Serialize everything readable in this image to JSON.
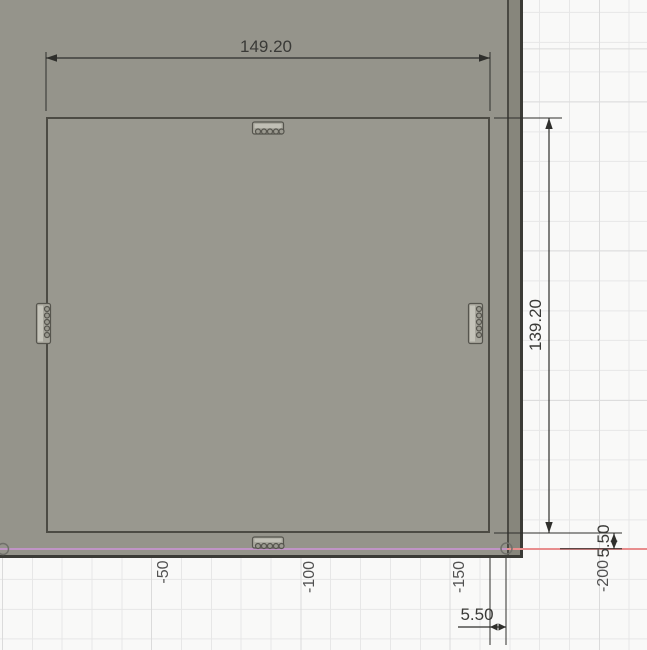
{
  "viewport": {
    "type": "cad-sketch-view",
    "dimensions": {
      "top_width": "149.20",
      "right_height": "139.20",
      "side_offset": "5.50",
      "bottom_offset": "5.50"
    },
    "axis_labels": [
      "-50",
      "-100",
      "-150",
      "-200"
    ],
    "colors": {
      "body_face": "#95948b",
      "body_side": "#87867c",
      "body_edge": "#3b3b36",
      "sketch_line": "#4c4b44",
      "grid_background": "#f9f9f8",
      "grid_line_minor": "#e7e7e7",
      "grid_line_major": "#dbdbdb",
      "x_axis": "#e88e8e",
      "projected_edge": "#c094c6",
      "dimension_ink": "#2f2f2c",
      "axis_label_ink": "#525252"
    }
  }
}
